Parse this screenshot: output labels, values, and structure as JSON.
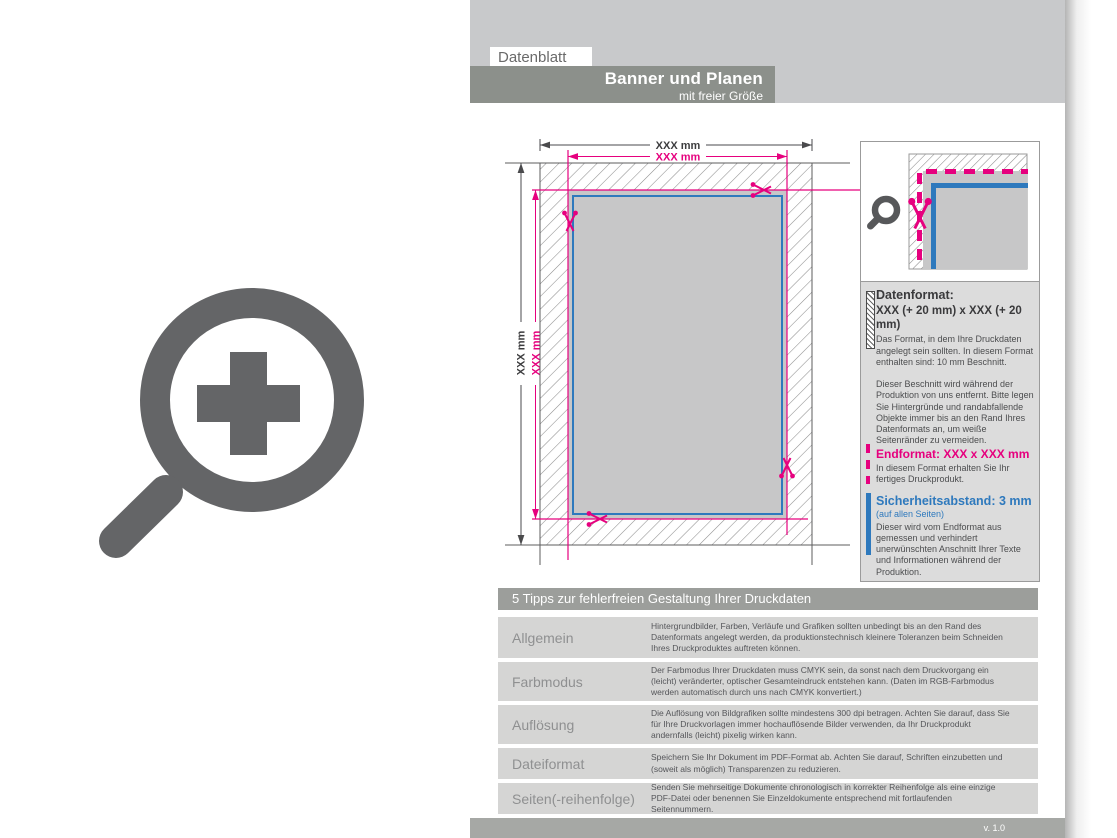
{
  "header": {
    "label": "Datenblatt",
    "title": "Banner und Planen",
    "subtitle": "mit freier Größe"
  },
  "diagram": {
    "dim_datenformat_width": "XXX mm",
    "dim_endformat_width": "XXX mm",
    "dim_datenformat_height": "XXX mm",
    "dim_endformat_height": "XXX mm"
  },
  "info_panel": {
    "datenformat": {
      "heading": "Datenformat:",
      "value": "XXX (+ 20 mm) x XXX (+ 20 mm)",
      "desc": "Das Format, in dem Ihre Druckdaten angelegt sein sollten. In diesem Format enthalten sind: 10 mm Beschnitt.",
      "desc2": "Dieser Beschnitt wird während der Produktion von uns entfernt. Bitte legen Sie Hintergründe und randabfallende Objekte immer bis an den Rand Ihres Datenformats an, um weiße Seitenränder zu vermeiden."
    },
    "endformat": {
      "heading": "Endformat: XXX x XXX mm",
      "desc": "In diesem Format erhalten Sie Ihr fertiges Druckprodukt."
    },
    "sicherheitsabstand": {
      "heading": "Sicherheitsabstand: 3 mm",
      "note": "(auf allen Seiten)",
      "desc": "Dieser wird vom Endformat aus gemessen und verhindert unerwünschten Anschnitt Ihrer Texte und Informationen während der Produktion."
    }
  },
  "tips_table": {
    "title": "5 Tipps zur fehlerfreien Gestaltung Ihrer Druckdaten",
    "rows": [
      {
        "label": "Allgemein",
        "text": "Hintergrundbilder, Farben, Verläufe und Grafiken sollten unbedingt bis an den Rand des Datenformats angelegt werden, da produktionstechnisch kleinere Toleranzen beim Schneiden Ihres Druckproduktes auftreten können."
      },
      {
        "label": "Farbmodus",
        "text": "Der Farbmodus Ihrer Druckdaten muss CMYK sein, da sonst nach dem Druckvorgang ein (leicht) veränderter, optischer Gesamteindruck entstehen kann. (Daten im RGB-Farbmodus werden automatisch durch uns nach CMYK konvertiert.)"
      },
      {
        "label": "Auflösung",
        "text": "Die Auflösung von Bildgrafiken sollte mindestens 300 dpi betragen. Achten Sie darauf, dass Sie für Ihre Druckvorlagen immer hochauflösende Bilder verwenden, da Ihr Druckprodukt andernfalls (leicht) pixelig wirken kann."
      },
      {
        "label": "Dateiformat",
        "text": "Speichern Sie Ihr Dokument im PDF-Format ab. Achten Sie darauf, Schriften einzubetten und (soweit als möglich) Transparenzen zu reduzieren."
      },
      {
        "label": "Seiten(-reihenfolge)",
        "text": "Senden Sie mehrseitige Dokumente chronologisch in korrekter Reihenfolge als eine einzige PDF-Datei oder benennen Sie Einzeldokumente entsprechend mit fortlaufenden Seitennummern."
      }
    ]
  },
  "footer": {
    "version": "v. 1.0"
  },
  "colors": {
    "magenta_endformat": "#e6007e",
    "blue_safety": "#2e79bd",
    "header_bar": "#8c908b",
    "band_gray": "#c8c9cb",
    "row_gray": "#d5d5d4"
  }
}
